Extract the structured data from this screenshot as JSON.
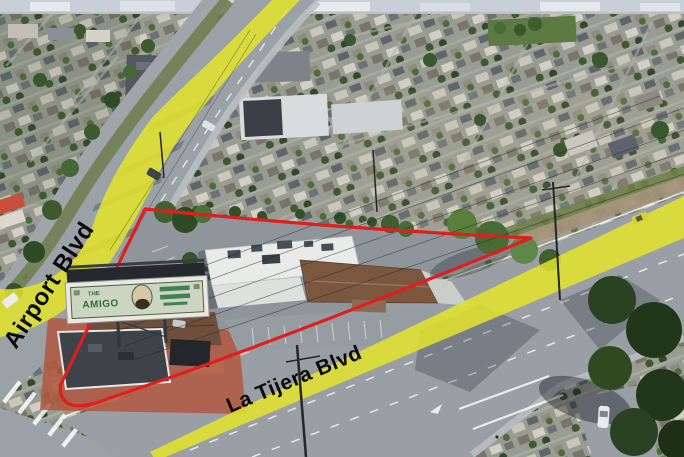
{
  "annotations": {
    "street_labels": [
      {
        "id": "airport-blvd",
        "text": "Airport Blvd"
      },
      {
        "id": "la-tijera-blvd",
        "text": "La Tijera Blvd"
      }
    ],
    "boundary_color": "#e01e1e",
    "highlight_color": "#e3e42c",
    "label_color": "#0a0a0a"
  },
  "billboard": {
    "line1": "THE",
    "line2": "AMIGO"
  }
}
